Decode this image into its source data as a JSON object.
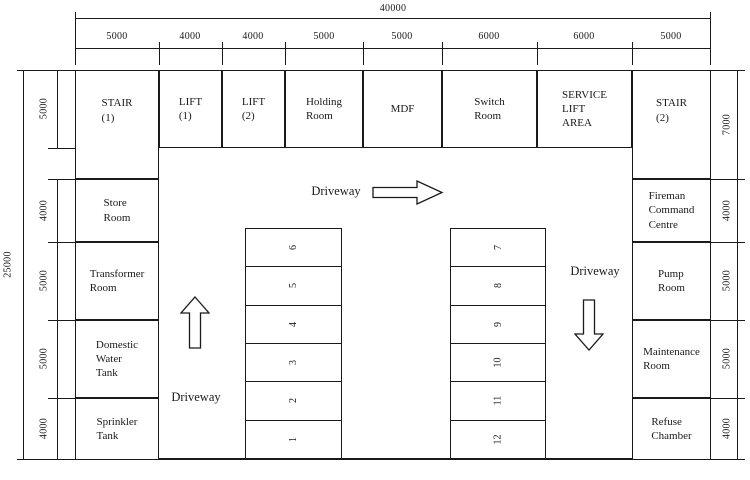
{
  "dims": {
    "overall_width": "40000",
    "overall_height": "25000",
    "top": [
      "5000",
      "4000",
      "4000",
      "5000",
      "5000",
      "6000",
      "6000",
      "5000"
    ],
    "left": [
      "5000",
      "4000",
      "5000",
      "5000",
      "4000"
    ],
    "right": [
      "7000",
      "4000",
      "5000",
      "5000",
      "4000"
    ]
  },
  "labels": {
    "driveway": "Driveway"
  },
  "rooms": {
    "stair1": "STAIR\n(1)",
    "lift1": "LIFT\n(1)",
    "lift2": "LIFT\n(2)",
    "holding": "Holding\nRoom",
    "mdf": "MDF",
    "switch": "Switch\nRoom",
    "service_lift": "SERVICE\nLIFT\nAREA",
    "stair2": "STAIR\n(2)",
    "store": "Store\nRoom",
    "transformer": "Transformer\nRoom",
    "domestic_water": "Domestic\nWater\nTank",
    "sprinkler": "Sprinkler\nTank",
    "fireman": "Fireman\nCommand\nCentre",
    "pump": "Pump\nRoom",
    "maintenance": "Maintenance\nRoom",
    "refuse": "Refuse\nChamber"
  },
  "parking": {
    "left_stalls": [
      "6",
      "5",
      "4",
      "3",
      "2",
      "1"
    ],
    "right_stalls": [
      "7",
      "8",
      "9",
      "10",
      "11",
      "12"
    ]
  },
  "colors": {
    "line": "#1a1a1a",
    "background": "#ffffff"
  }
}
